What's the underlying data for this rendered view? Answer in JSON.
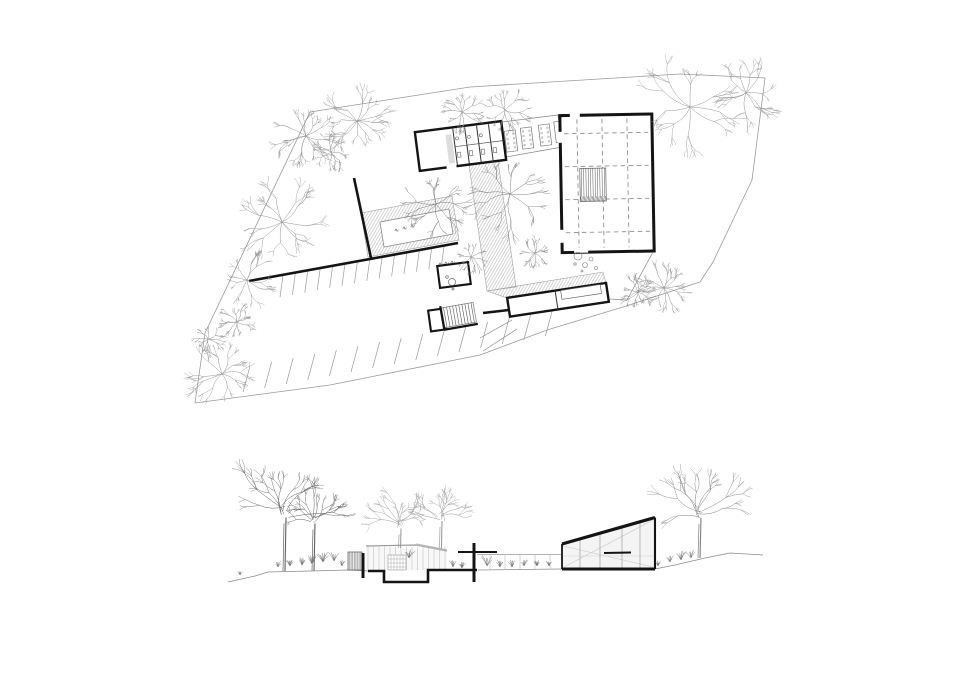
{
  "canvas": {
    "w": 960,
    "h": 700,
    "bg": "#ffffff"
  },
  "palette": {
    "wall": "#141414",
    "boundary": "#9a9a9a",
    "thin": "#8c8c8c",
    "lighter": "#b9b9b9",
    "hatch": "#a9a9a9",
    "dash": "#909090",
    "planTree": "#8a8a8a",
    "planTreeDark": "#707070",
    "treeDark": "#606060",
    "treeMid": "#7d7d7d",
    "treeLight": "#9d9d9d",
    "lightFill": "#f4f4f4",
    "paleFill": "#f8f8f8",
    "white": "#ffffff",
    "detail": "#555555"
  },
  "plan": {
    "boundary": [
      [
        310,
        112
      ],
      [
        470,
        87
      ],
      [
        680,
        74
      ],
      [
        765,
        78
      ],
      [
        752,
        180
      ],
      [
        713,
        262
      ],
      [
        700,
        282
      ],
      [
        623,
        307
      ],
      [
        547,
        330
      ],
      [
        480,
        355
      ],
      [
        330,
        385
      ],
      [
        195,
        403
      ],
      [
        205,
        333
      ]
    ],
    "walls": [
      [
        [
          354,
          178
        ],
        [
          371,
          258
        ]
      ],
      [
        [
          249,
          281
        ],
        [
          458,
          243
        ]
      ],
      [
        [
          483,
          313
        ],
        [
          509,
          310
        ]
      ]
    ],
    "parking_rows": [
      {
        "n": 14,
        "x": 283,
        "y": 275.3,
        "dx": 12.4,
        "dy": -2.33,
        "vx": -3,
        "vy": 22
      },
      {
        "n": 15,
        "x": 243,
        "y": 392,
        "dx": 21.6,
        "dy": -4.0,
        "vx": 7,
        "vy": -26
      }
    ],
    "hatches": [
      [
        [
          468,
          158
        ],
        [
          497,
          154
        ],
        [
          516,
          287
        ],
        [
          487,
          291
        ]
      ],
      [
        [
          361,
          213
        ],
        [
          452,
          196
        ],
        [
          459,
          240
        ],
        [
          368,
          257
        ]
      ],
      [
        [
          487,
          291
        ],
        [
          603,
          272
        ],
        [
          606,
          283
        ],
        [
          510,
          299
        ]
      ]
    ],
    "pool": [
      [
        380,
        222
      ],
      [
        449,
        209
      ],
      [
        453,
        234
      ],
      [
        384,
        247
      ]
    ],
    "pool_waves": [
      [
        397,
        229
      ],
      [
        405,
        227
      ],
      [
        413,
        225
      ]
    ],
    "room_waves": [
      [
        441,
        263
      ],
      [
        447,
        262
      ],
      [
        453,
        261
      ]
    ],
    "walkway": [
      [
        502,
        122
      ],
      [
        558,
        115
      ],
      [
        562,
        147
      ],
      [
        506,
        157
      ]
    ],
    "tables": [
      [
        511,
        141
      ],
      [
        527,
        138
      ],
      [
        545,
        135
      ],
      [
        558,
        132
      ]
    ],
    "table_size": {
      "w": 11,
      "h": 21,
      "ang": -7
    },
    "b1": {
      "cx": 460.5,
      "cy": 146,
      "w": 87,
      "h": 39,
      "ang": -7.3
    },
    "hall": {
      "cx": 607,
      "cy": 183.3,
      "w": 92,
      "h": 137,
      "ang": -1,
      "vlines": [
        578,
        603,
        628
      ],
      "hlines": [
        133,
        166,
        199,
        232
      ],
      "stair": {
        "x": 580,
        "y": 168,
        "w": 26,
        "h": 28,
        "hatch_h": 5
      },
      "gaps": [
        [
          558.6,
          131,
          4.8,
          11
        ],
        [
          558.6,
          229,
          4.8,
          13
        ],
        [
          571,
          112.3,
          10,
          4.8
        ],
        [
          573,
          247.5,
          14,
          4.8
        ]
      ]
    },
    "rooms": [
      {
        "cx": 454,
        "cy": 275,
        "w": 31,
        "h": 22,
        "ang": -7.4
      },
      {
        "cx": 437,
        "cy": 320,
        "w": 15,
        "h": 21,
        "ang": -8
      }
    ],
    "stairs": {
      "cx": 459,
      "cy": 315,
      "w": 32,
      "h": 20,
      "ang": -10,
      "steps": 10
    },
    "b5": {
      "cx": 558,
      "cy": 299.8,
      "w": 100,
      "h": 19,
      "ang": -8.6
    },
    "b5_table": {
      "cx": 582,
      "cy": 291.5,
      "w": 40,
      "h": 9
    },
    "b5_div": [
      [
        556,
        291
      ],
      [
        559,
        309
      ]
    ],
    "terrace": [
      [
        [
          653,
          252
        ],
        [
          627,
          300
        ]
      ],
      [
        [
          627,
          300
        ],
        [
          609,
          299
        ]
      ]
    ],
    "stones": [
      [
        578,
        256,
        4
      ],
      [
        585,
        265,
        2.5
      ],
      [
        591,
        259,
        2
      ],
      [
        575,
        264,
        1.2
      ],
      [
        596,
        268,
        1.5
      ],
      [
        582,
        271,
        1
      ]
    ],
    "paths": [
      [
        [
          512,
          320
        ],
        [
          480,
          338
        ]
      ],
      [
        [
          517,
          329
        ],
        [
          483,
          351
        ]
      ]
    ],
    "fixtures": [
      [
        452,
        282,
        3.5
      ],
      [
        447,
        277,
        1.3
      ],
      [
        453,
        289,
        1
      ]
    ],
    "trees": [
      [
        306,
        136,
        24
      ],
      [
        357,
        121,
        27
      ],
      [
        331,
        152,
        14
      ],
      [
        462,
        112,
        16
      ],
      [
        505,
        110,
        17
      ],
      [
        690,
        107,
        40
      ],
      [
        746,
        93,
        26
      ],
      [
        282,
        222,
        32
      ],
      [
        247,
        280,
        20
      ],
      [
        237,
        322,
        14
      ],
      [
        208,
        339,
        12
      ],
      [
        222,
        374,
        24
      ],
      [
        436,
        204,
        26
      ],
      [
        510,
        194,
        31
      ],
      [
        471,
        257,
        12
      ],
      [
        535,
        253,
        12
      ],
      [
        638,
        292,
        13
      ],
      [
        664,
        288,
        19
      ]
    ]
  },
  "elevation": {
    "ground_left": [
      [
        228,
        582
      ],
      [
        255,
        576
      ],
      [
        268,
        572
      ],
      [
        310,
        571
      ],
      [
        348,
        570
      ],
      [
        368,
        571
      ]
    ],
    "ground_mid": [
      [
        478,
        570
      ],
      [
        562,
        569
      ]
    ],
    "ground_right": [
      [
        655,
        569
      ],
      [
        675,
        565
      ],
      [
        705,
        558
      ],
      [
        730,
        553
      ],
      [
        763,
        555
      ]
    ],
    "pit": [
      [
        368,
        571
      ],
      [
        384,
        571
      ],
      [
        384,
        582
      ],
      [
        428,
        582
      ],
      [
        428,
        570
      ],
      [
        477,
        570
      ]
    ],
    "posts": [
      [
        363,
        553,
        578
      ],
      [
        474,
        543,
        582
      ]
    ],
    "black_roof": [
      [
        458,
        552
      ],
      [
        497,
        552
      ]
    ],
    "louver": {
      "x": 348,
      "y": 552,
      "w": 14,
      "h": 18
    },
    "pav_fill": [
      [
        366,
        546
      ],
      [
        447,
        551
      ],
      [
        447,
        570
      ],
      [
        366,
        570
      ]
    ],
    "pav_roof": [
      [
        366,
        546
      ],
      [
        416,
        545
      ],
      [
        447,
        551
      ]
    ],
    "pav_accent": [
      [
        416,
        544.5
      ],
      [
        447,
        550.5
      ]
    ],
    "pav_mull": {
      "x0": 368,
      "x1": 446,
      "step": 5.5,
      "ytop": 546.5,
      "ybot": 570
    },
    "window": {
      "x": 388,
      "y": 555,
      "w": 18,
      "h": 15
    },
    "link": {
      "x0": 477,
      "x1": 562,
      "ytop": 554.5,
      "ybot": 569,
      "mull": [
        490,
        505,
        520,
        535,
        550
      ]
    },
    "wedge": {
      "x0": 562,
      "x1": 655,
      "ytl": 544,
      "ytr": 517.5,
      "ybase": 569,
      "mull": [
        580,
        600,
        622,
        640
      ],
      "diag": [
        [
          [
            563,
            546
          ],
          [
            653,
            567
          ]
        ],
        [
          [
            564,
            567
          ],
          [
            653,
            520
          ]
        ]
      ],
      "bar": [
        [
          604,
          553
        ],
        [
          631,
          552.5
        ]
      ],
      "floor": 556
    },
    "grass": [
      [
        240,
        575,
        1
      ],
      [
        278,
        567,
        1.4
      ],
      [
        290,
        566,
        1.6
      ],
      [
        302,
        565,
        1.8
      ],
      [
        312,
        564,
        2
      ],
      [
        323,
        562,
        2.4
      ],
      [
        334,
        561,
        2.2
      ],
      [
        342,
        566,
        1.5
      ],
      [
        409,
        558,
        2
      ],
      [
        453,
        567,
        1.6
      ],
      [
        462,
        568,
        1.4
      ],
      [
        487,
        566,
        2.6
      ],
      [
        500,
        567,
        1.8
      ],
      [
        512,
        567,
        1.6
      ],
      [
        524,
        566,
        1.6
      ],
      [
        537,
        566,
        1.4
      ],
      [
        549,
        566,
        1.2
      ],
      [
        658,
        566,
        1.2
      ],
      [
        670,
        562,
        1.6
      ],
      [
        681,
        560,
        2.2
      ],
      [
        691,
        558,
        1.8
      ]
    ],
    "trees": [
      {
        "x": 285,
        "y": 505,
        "r": 50,
        "base": 571,
        "tone": "dark"
      },
      {
        "x": 314,
        "y": 516,
        "r": 30,
        "base": 571,
        "tone": "dark"
      },
      {
        "x": 400,
        "y": 521,
        "r": 30,
        "base": 570,
        "tone": "light"
      },
      {
        "x": 441,
        "y": 514,
        "r": 28,
        "base": 570,
        "tone": "light"
      },
      {
        "x": 700,
        "y": 506,
        "r": 47,
        "base": 558,
        "tone": "mid"
      }
    ]
  }
}
